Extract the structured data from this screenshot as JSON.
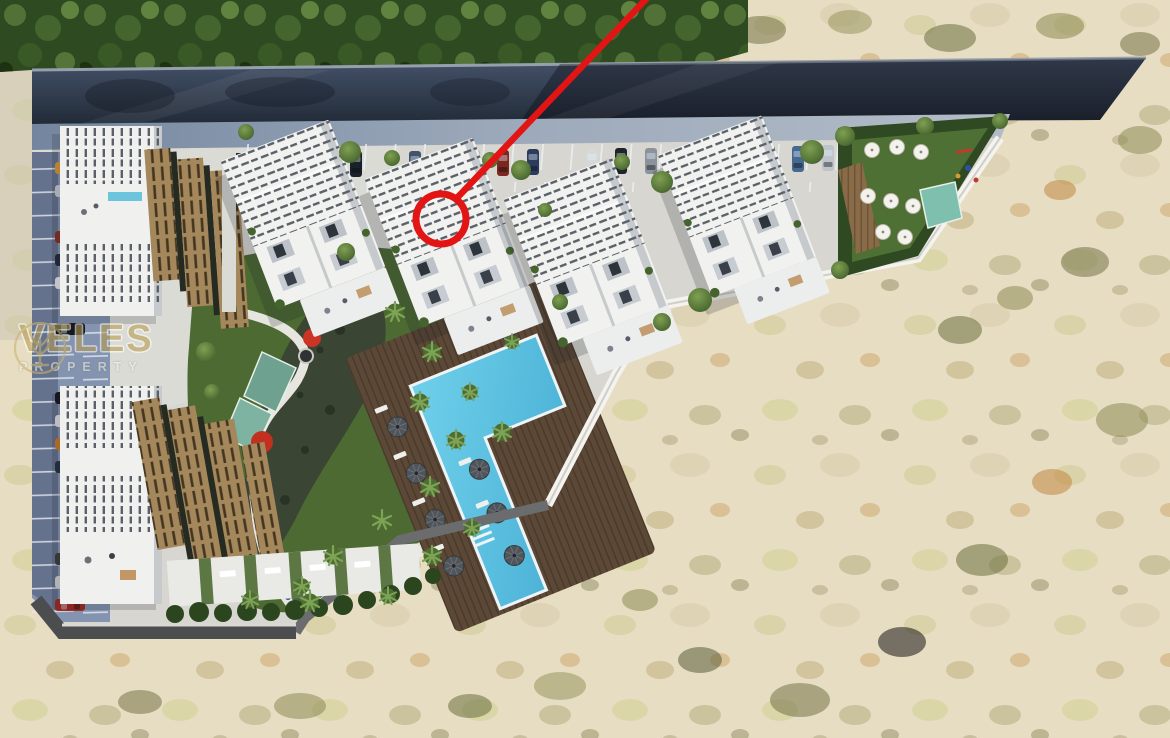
{
  "watermark": {
    "brand": "VELES",
    "subtitle": "PROPERTY"
  },
  "annotation": {
    "type": "callout",
    "meaning": "red circle highlighting one unit, red leader line running to top edge",
    "color": "#e31414"
  },
  "scene": {
    "description": "Aerial 3D render of a residential complex: rows of tilted white villas with slatted roofs, wooden pergola blocks, an L-shaped blue swimming pool on a timber deck with umbrellas, central landscaped garden with palms and red flowering trees, street-side and lateral parking with cars, amenity lawn with shade sail and playground, all bordered by a road with trees at top and sandy scrubland to the right and bottom",
    "palette": {
      "sand": "#e7ddc3",
      "tree_band": "#2e4a20",
      "road": "#2a3441",
      "sidewalk": "#8e9eb8",
      "site_pavement": "#d7d6d0",
      "building_white": "#f1f2f0",
      "pergola_wood": "#a5875c",
      "pool_water": "#4fb6da",
      "pool_deck": "#5c4836",
      "lawn": "#4c6a31",
      "marker_red": "#e31414",
      "watermark_gold": "#b89c4e"
    }
  }
}
